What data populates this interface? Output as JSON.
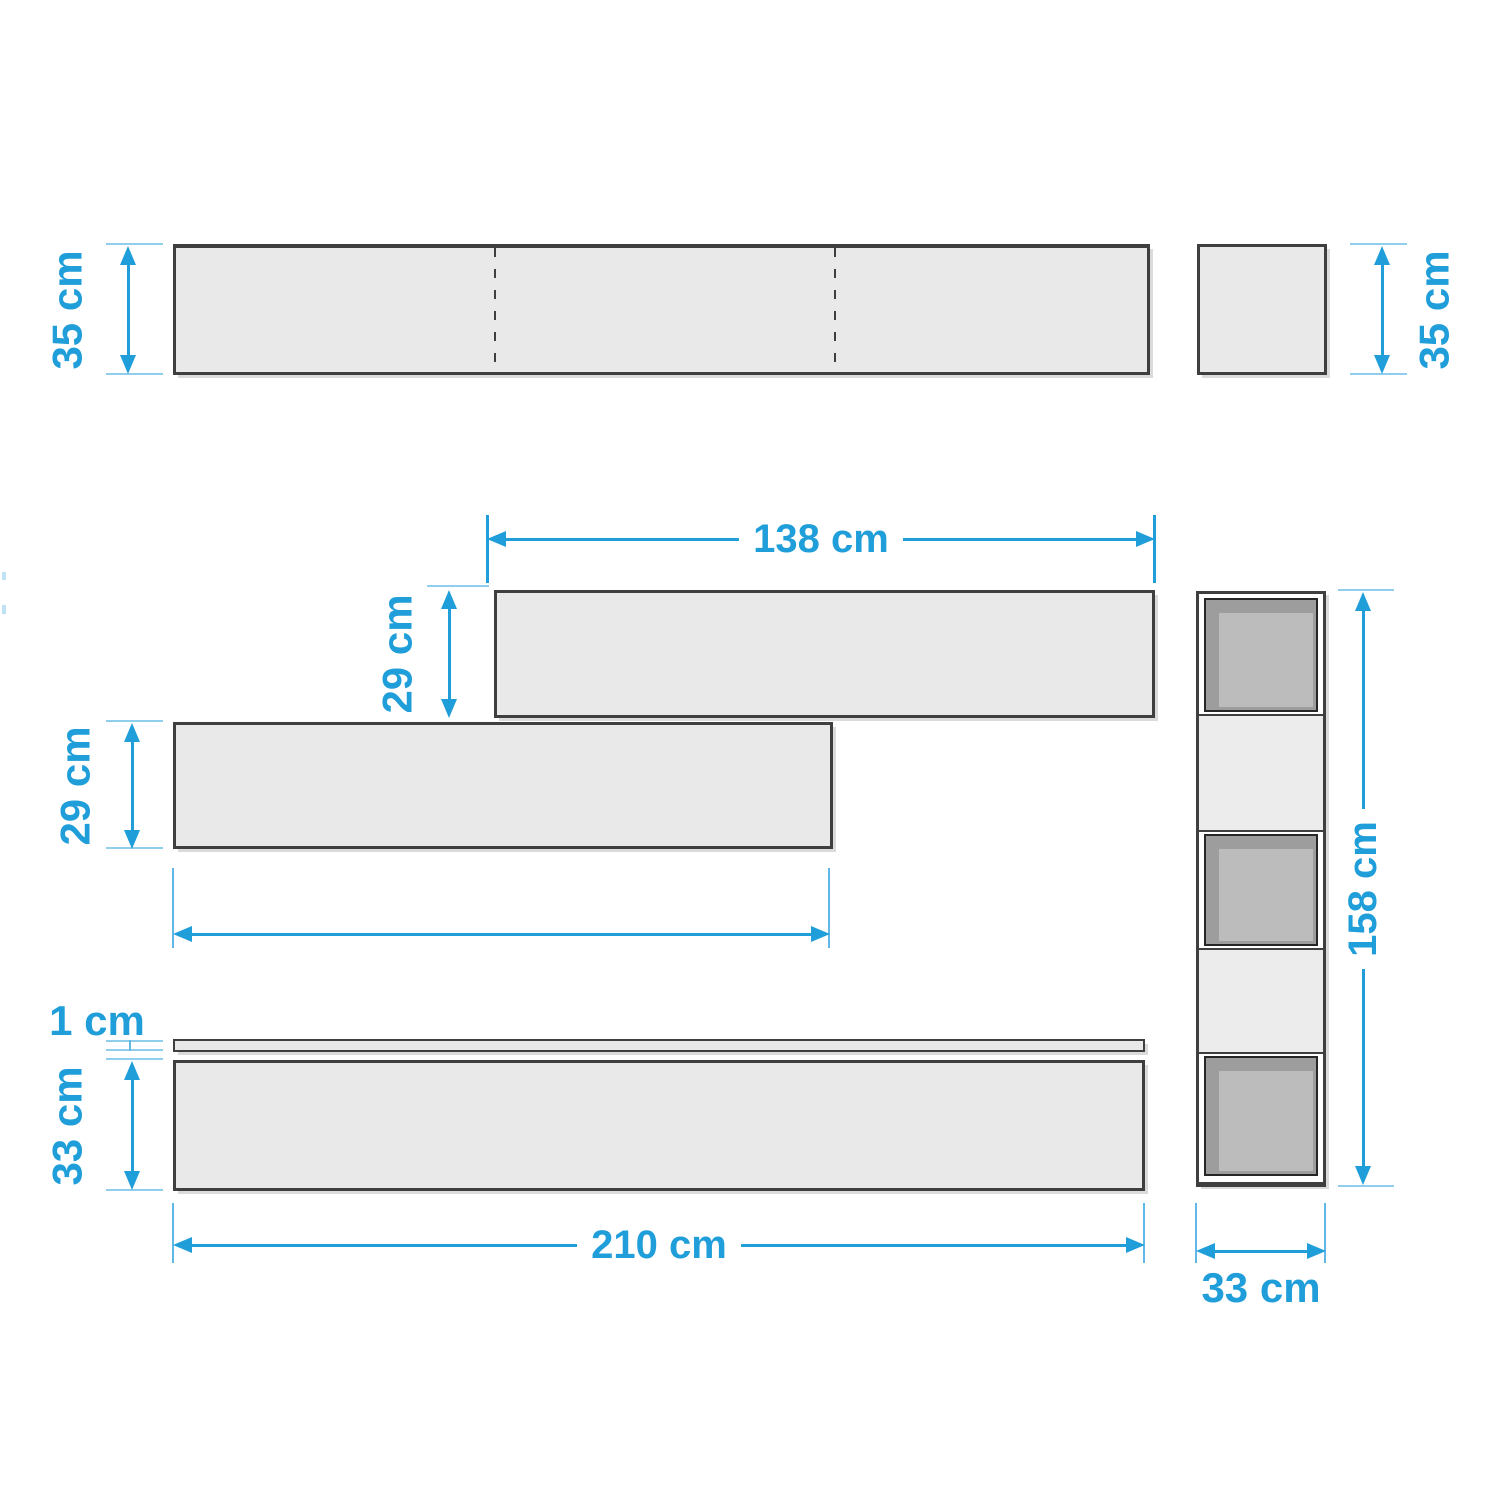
{
  "colors": {
    "accent_blue": "#1F9ED9",
    "extension_line_blue": "#8FCEEC",
    "outline_gray": "#3F3F3F",
    "panel_fill_gray": "#E9E9E9",
    "compartment_dark_gray": "#9D9D9D",
    "compartment_inner_gray": "#BCBCBC"
  },
  "top_view": {
    "shelf_depth_label": "35 cm",
    "end_panel_depth_label": "35 cm"
  },
  "front_view": {
    "upper_shelf_width_label": "138 cm",
    "upper_shelf_height_label": "29 cm",
    "lower_shelf_height_label": "29 cm"
  },
  "base_view": {
    "top_panel_thickness_label": "1 cm",
    "base_height_label": "33 cm",
    "base_width_label": "210 cm"
  },
  "column_view": {
    "height_label": "158 cm",
    "depth_label": "33 cm"
  }
}
